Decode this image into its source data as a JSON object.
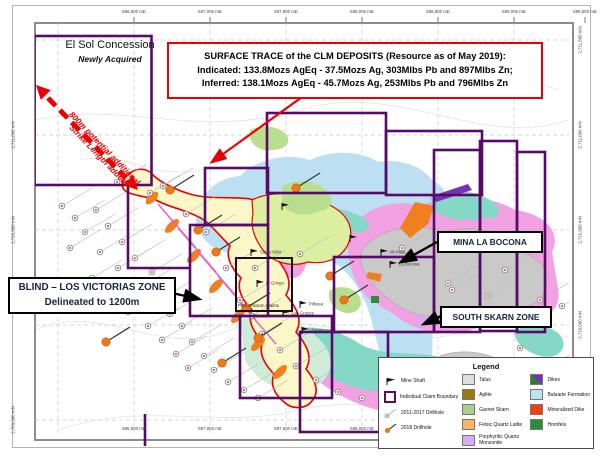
{
  "resource_box": {
    "line1": "SURFACE TRACE of the CLM DEPOSITS (Resource as of May 2019):",
    "line2": "Indicated: 133.8Mozs AgEq  - 37.5Mozs Ag, 303Mlbs Pb and 897Mlbs Zn;",
    "line3": "Inferred: 138.1Mozs AgEq  -   45.7Mozs Ag, 253Mlbs Pb and 796Mlbs Zn"
  },
  "el_sol": {
    "title": "El Sol Concession",
    "subtitle": "Newly Acquired",
    "arrow_label_line1": "800m potential additional",
    "arrow_label_line2": "Strike Length added"
  },
  "zone_labels": {
    "blind_line1": "BLIND – LOS VICTORIAS ZONE",
    "blind_line2": "Delineated to 1200m",
    "mina": "MINA LA BOCONA",
    "south_skarn": "SOUTH SKARN ZONE",
    "puro_corazon": "Puro Corazon Claims"
  },
  "mine_shafts": [
    {
      "x": 381,
      "y": 256,
      "label": "Mi Plata"
    },
    {
      "x": 390,
      "y": 268,
      "label": "La Bocona"
    },
    {
      "x": 251,
      "y": 256,
      "label": "Santo Niño"
    },
    {
      "x": 257,
      "y": 287,
      "label": "El Gringo"
    },
    {
      "x": 300,
      "y": 308,
      "label": "Pilhasa"
    },
    {
      "x": 302,
      "y": 334,
      "label": "Zacatecas"
    },
    {
      "x": 283,
      "y": 317,
      "label": "Las Cruces"
    },
    {
      "x": 282,
      "y": 210,
      "label": ""
    },
    {
      "x": 350,
      "y": 242,
      "label": ""
    }
  ],
  "axes": {
    "top_eastings": [
      {
        "x": 134,
        "label": "586,500 mE"
      },
      {
        "x": 210,
        "label": "587,000 mE"
      },
      {
        "x": 286,
        "label": "587,500 mE"
      },
      {
        "x": 362,
        "label": "588,000 mE"
      },
      {
        "x": 438,
        "label": "588,500 mE"
      },
      {
        "x": 514,
        "label": "589,000 mE"
      },
      {
        "x": 585,
        "label": "589,500 mE"
      }
    ],
    "bottom_eastings": [
      {
        "x": 134,
        "label": "586,500 mE"
      },
      {
        "x": 210,
        "label": "587,000 mE"
      },
      {
        "x": 286,
        "label": "587,500 mE"
      },
      {
        "x": 362,
        "label": "588,000 mE"
      }
    ],
    "left_northings": [
      {
        "y": 135,
        "label": "2,711,000 mN"
      },
      {
        "y": 230,
        "label": "2,710,500 mN"
      },
      {
        "y": 420,
        "label": "2,709,500 mN"
      }
    ],
    "right_northings": [
      {
        "y": 40,
        "label": "2,711,500 mN"
      },
      {
        "y": 135,
        "label": "2,711,000 mN"
      },
      {
        "y": 230,
        "label": "2,710,500 mN"
      },
      {
        "y": 325,
        "label": "2,710,000 mN"
      }
    ]
  },
  "legend": {
    "title": "Legend",
    "markers": [
      {
        "label": "Mine Shaft"
      },
      {
        "label": "Individual Claim Boundary"
      },
      {
        "label": "2011-2017 Drillhole"
      },
      {
        "label": "2018 Drillhole"
      }
    ],
    "units_col1": [
      {
        "label": "Talus",
        "color": "#DEDEDE"
      },
      {
        "label": "Aplite",
        "color": "#9A7B0A"
      },
      {
        "label": "Garnet Skarn",
        "color": "#A8D08D"
      },
      {
        "label": "Felsic Quartz Latite",
        "color": "#FCB469"
      },
      {
        "label": "Porphyritic Quartz Monzonite",
        "color": "#D8ABF0"
      }
    ],
    "units_col2": [
      {
        "label": "Dikes",
        "colors": [
          "#2E7D32",
          "#7A2FB8"
        ]
      },
      {
        "label": "Baluarte Formation",
        "color": "#BDE2F4"
      },
      {
        "label": "Mineralized Dike",
        "color": "#F2400C"
      },
      {
        "label": "Hornfels",
        "color": "#2E8B3A"
      }
    ]
  },
  "map_data": {
    "drillholes_2011_2017": [
      [
        117,
        182
      ],
      [
        150,
        193
      ],
      [
        163,
        186
      ],
      [
        62,
        206
      ],
      [
        75,
        218
      ],
      [
        96,
        210
      ],
      [
        108,
        226
      ],
      [
        85,
        232
      ],
      [
        122,
        242
      ],
      [
        100,
        252
      ],
      [
        70,
        248
      ],
      [
        135,
        258
      ],
      [
        118,
        268
      ],
      [
        92,
        278
      ],
      [
        152,
        272
      ],
      [
        140,
        288
      ],
      [
        106,
        296
      ],
      [
        160,
        300
      ],
      [
        128,
        312
      ],
      [
        170,
        314
      ],
      [
        148,
        326
      ],
      [
        182,
        326
      ],
      [
        162,
        340
      ],
      [
        192,
        342
      ],
      [
        176,
        354
      ],
      [
        204,
        356
      ],
      [
        188,
        368
      ],
      [
        214,
        370
      ],
      [
        228,
        382
      ],
      [
        244,
        390
      ],
      [
        258,
        398
      ],
      [
        186,
        214
      ],
      [
        206,
        232
      ],
      [
        226,
        268
      ],
      [
        240,
        300
      ],
      [
        252,
        316
      ],
      [
        262,
        334
      ],
      [
        280,
        350
      ],
      [
        296,
        366
      ],
      [
        316,
        380
      ],
      [
        338,
        392
      ],
      [
        362,
        398
      ],
      [
        390,
        402
      ],
      [
        300,
        254
      ],
      [
        255,
        268
      ],
      [
        402,
        248
      ],
      [
        448,
        283
      ],
      [
        505,
        270
      ],
      [
        452,
        290
      ],
      [
        488,
        296
      ],
      [
        540,
        300
      ],
      [
        562,
        306
      ],
      [
        520,
        348
      ],
      [
        548,
        368
      ],
      [
        420,
        392
      ],
      [
        468,
        402
      ]
    ],
    "drillholes_2018": [
      [
        170,
        190
      ],
      [
        198,
        230
      ],
      [
        216,
        252
      ],
      [
        246,
        308
      ],
      [
        258,
        338
      ],
      [
        106,
        342
      ],
      [
        222,
        363
      ],
      [
        296,
        188
      ],
      [
        330,
        276
      ],
      [
        344,
        300
      ]
    ]
  },
  "colors": {
    "claim_boundary": "#570B69",
    "surface_trace": "#E90000",
    "drillhole_2018": "#F07818",
    "talus": "#C9C9C9",
    "baluarte": "#BCE0F2",
    "pink_intrusive": "#F2A2E2",
    "teal_unit": "#84D9C6",
    "band_yellow": "#FBF7C9",
    "skarn_green": "#B9DF8E"
  }
}
